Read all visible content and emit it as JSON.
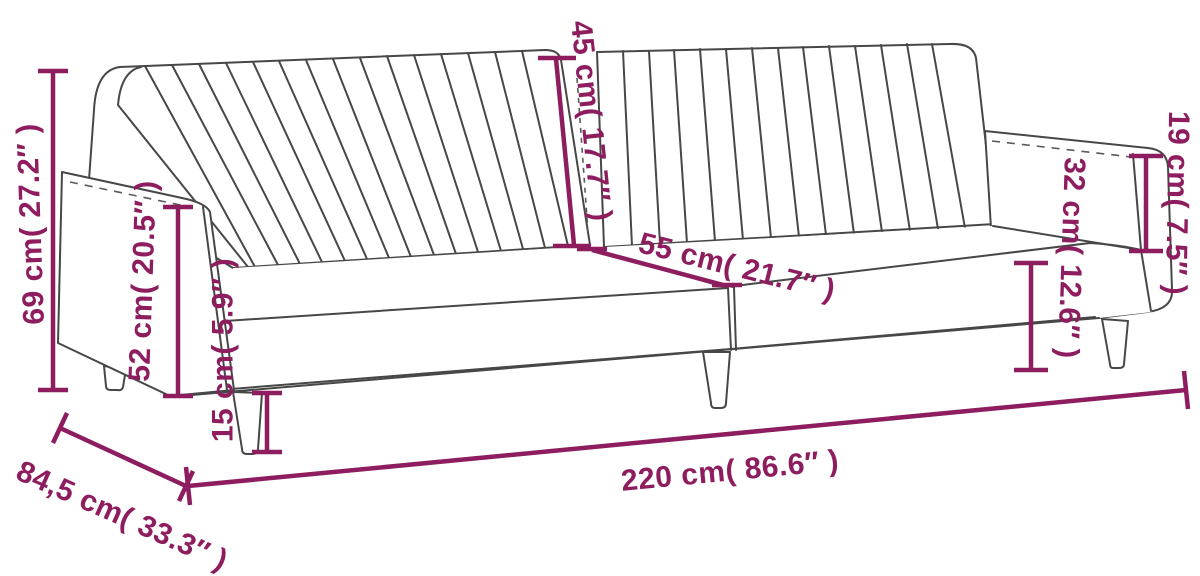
{
  "diagram": {
    "title": "Sofa bed dimension drawing",
    "product": "2-seater channel-tufted sofa bed with armrests and tapered legs",
    "units": [
      "cm",
      "inches"
    ],
    "colors": {
      "dimension_color": "#8e1d5f",
      "outline_color": "#474747",
      "background": "#ffffff"
    },
    "dimensions": [
      {
        "id": "overall-height",
        "label": "69 cm( 27.2″ )",
        "cm": 69,
        "inches": 27.2
      },
      {
        "id": "armrest-front-height",
        "label": "52 cm( 20.5″ )",
        "cm": 52,
        "inches": 20.5
      },
      {
        "id": "leg-height",
        "label": "15 cm( 5.9″ )",
        "cm": 15,
        "inches": 5.9
      },
      {
        "id": "backrest-height",
        "label": "45 cm( 17.7″ )",
        "cm": 45,
        "inches": 17.7
      },
      {
        "id": "seat-depth",
        "label": "55 cm( 21.7″ )",
        "cm": 55,
        "inches": 21.7
      },
      {
        "id": "side-height",
        "label": "32 cm( 12.6″ )",
        "cm": 32,
        "inches": 12.6
      },
      {
        "id": "armrest-above-seat",
        "label": "19 cm( 7.5″ )",
        "cm": 19,
        "inches": 7.5
      },
      {
        "id": "overall-width",
        "label": "220 cm( 86.6″ )",
        "cm": 220,
        "inches": 86.6
      },
      {
        "id": "overall-depth",
        "label": "84,5 cm( 33.3″ )",
        "cm": 84.5,
        "inches": 33.3
      }
    ]
  }
}
